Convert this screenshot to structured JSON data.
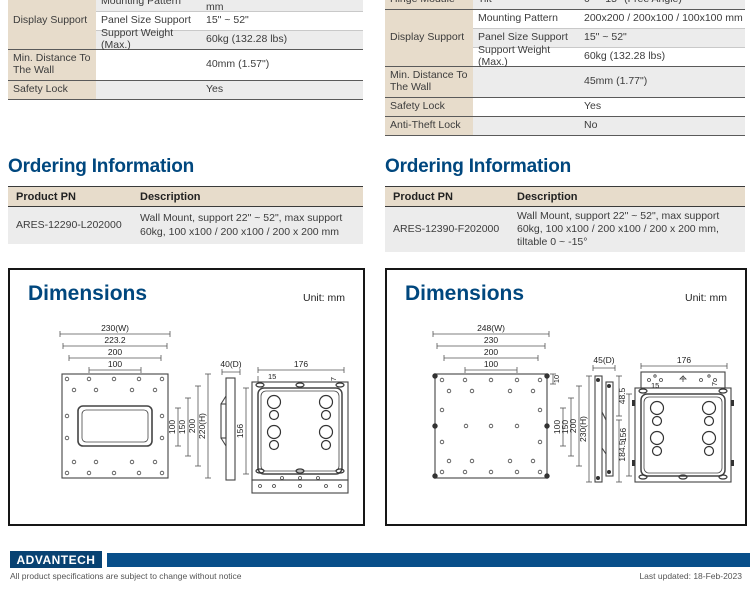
{
  "left": {
    "spec": {
      "group_display": "Display Support",
      "rows": [
        {
          "label": "Mounting Pattern",
          "value": "200x200 / 200x100 / 100x100 mm"
        },
        {
          "label": "Panel Size Support",
          "value": "15\" ~ 52\""
        },
        {
          "label": "Support Weight (Max.)",
          "value": "60kg (132.28 lbs)"
        },
        {
          "group": "Min. Distance To The Wall",
          "value": "40mm (1.57\")"
        },
        {
          "group": "Safety Lock",
          "value": "Yes"
        }
      ]
    },
    "ordering": {
      "title": "Ordering Information",
      "col_pn": "Product PN",
      "col_desc": "Description",
      "pn": "ARES-12290-L202000",
      "desc": "Wall Mount, support 22\" ~ 52\", max support 60kg, 100 x100 / 200 x100 / 200 x 200 mm"
    },
    "dim": {
      "title": "Dimensions",
      "unit": "Unit: mm",
      "front_top": [
        "230(W)",
        "223.2",
        "200",
        "100"
      ],
      "front_right": [
        "100",
        "150",
        "200",
        "220(H)"
      ],
      "side_depth": "40(D)",
      "rear_width": "176",
      "rear_offset": "15",
      "rear_small": "7",
      "rear_height": "156"
    }
  },
  "right": {
    "spec": {
      "group_hinge": "Hinge Module",
      "group_display": "Display Support",
      "rows": [
        {
          "label": "Tilt",
          "value": "0 ~ -15° (Free Angle)"
        },
        {
          "label": "Mounting Pattern",
          "value": "200x200 / 200x100 / 100x100 mm"
        },
        {
          "label": "Panel Size Support",
          "value": "15\" ~ 52\""
        },
        {
          "label": "Support Weight (Max.)",
          "value": "60kg (132.28 lbs)"
        },
        {
          "group": "Min. Distance To The Wall",
          "value": "45mm (1.77\")"
        },
        {
          "group": "Safety Lock",
          "value": "Yes"
        },
        {
          "group": "Anti-Theft Lock",
          "value": "No"
        }
      ]
    },
    "ordering": {
      "title": "Ordering Information",
      "col_pn": "Product PN",
      "col_desc": "Description",
      "pn": "ARES-12390-F202000",
      "desc": "Wall Mount, support 22\" ~ 52\", max support 60kg, 100 x100 / 200 x100 / 200 x 200 mm, tiltable 0 ~ -15°"
    },
    "dim": {
      "title": "Dimensions",
      "unit": "Unit: mm",
      "front_top": [
        "248(W)",
        "230",
        "200",
        "100"
      ],
      "front_top_small": "10",
      "front_right": [
        "100",
        "150",
        "200"
      ],
      "side_depth": "45(D)",
      "side_height": "230(H)",
      "side_upper": "48.5",
      "side_lower": "184.5",
      "rear_width": "176",
      "rear_offset": "15",
      "rear_small": "7",
      "rear_height": "156"
    }
  },
  "footer": {
    "logo": "ADVANTECH",
    "disclaimer": "All product specifications are subject to change without notice",
    "updated": "Last updated: 18-Feb-2023"
  },
  "colors": {
    "heading_blue": "#00477e",
    "beige": "#e7dccb",
    "stripe": "#ececec",
    "footer_blue": "#084f8a"
  }
}
